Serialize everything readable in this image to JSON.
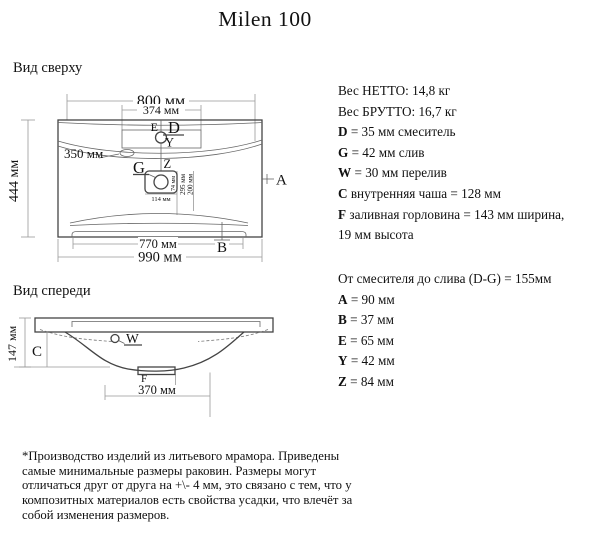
{
  "title": "Milen 100",
  "top_view": {
    "label": "Вид сверху",
    "dims": {
      "d800": "800 мм",
      "d374": "374 мм",
      "d444": "444 мм",
      "d350": "350 мм",
      "d770": "770 мм",
      "d990": "990 мм",
      "d114": "114 мм",
      "d74": "74 мм",
      "d295": "295 мм",
      "d200": "200 мм"
    },
    "markers": {
      "a": "A",
      "b": "B",
      "d": "D",
      "e": "E",
      "g": "G",
      "y": "Y",
      "z": "Z"
    }
  },
  "front_view": {
    "label": "Вид спереди",
    "dims": {
      "d147": "147 мм",
      "d370": "370 мм"
    },
    "markers": {
      "c": "C",
      "w": "W",
      "f": "F"
    }
  },
  "specs": {
    "block1": [
      {
        "b": "",
        "t": "Вес НЕТТО: 14,8 кг"
      },
      {
        "b": "",
        "t": "Вес БРУТТО: 16,7 кг"
      },
      {
        "b": "D",
        "t": " = 35 мм смеситель"
      },
      {
        "b": "G",
        "t": " = 42 мм слив"
      },
      {
        "b": "W",
        "t": " = 30 мм перелив"
      },
      {
        "b": "C",
        "t": " внутренняя чаша = 128 мм"
      },
      {
        "b": "F",
        "t": " заливная горловина = 143 мм ширина,"
      },
      {
        "b": "",
        "t": "19 мм высота"
      }
    ],
    "block2": [
      {
        "b": "",
        "t": "От смесителя до слива (D-G) = 155мм"
      },
      {
        "b": "A",
        "t": " = 90 мм"
      },
      {
        "b": "B",
        "t": " = 37 мм"
      },
      {
        "b": "E",
        "t": " = 65 мм"
      },
      {
        "b": "Y",
        "t": " = 42 мм"
      },
      {
        "b": "Z",
        "t": " = 84 мм"
      }
    ]
  },
  "disclaimer": {
    "lines": [
      "*Производство изделий из литьевого мрамора. Приведены",
      "самые минимальные размеры раковин. Размеры могут",
      "отличаться друг от друга на +\\- 4 мм, это связано с тем, что у",
      "композитных материалов есть свойства усадки, что влечёт за",
      "собой изменения размеров."
    ]
  }
}
